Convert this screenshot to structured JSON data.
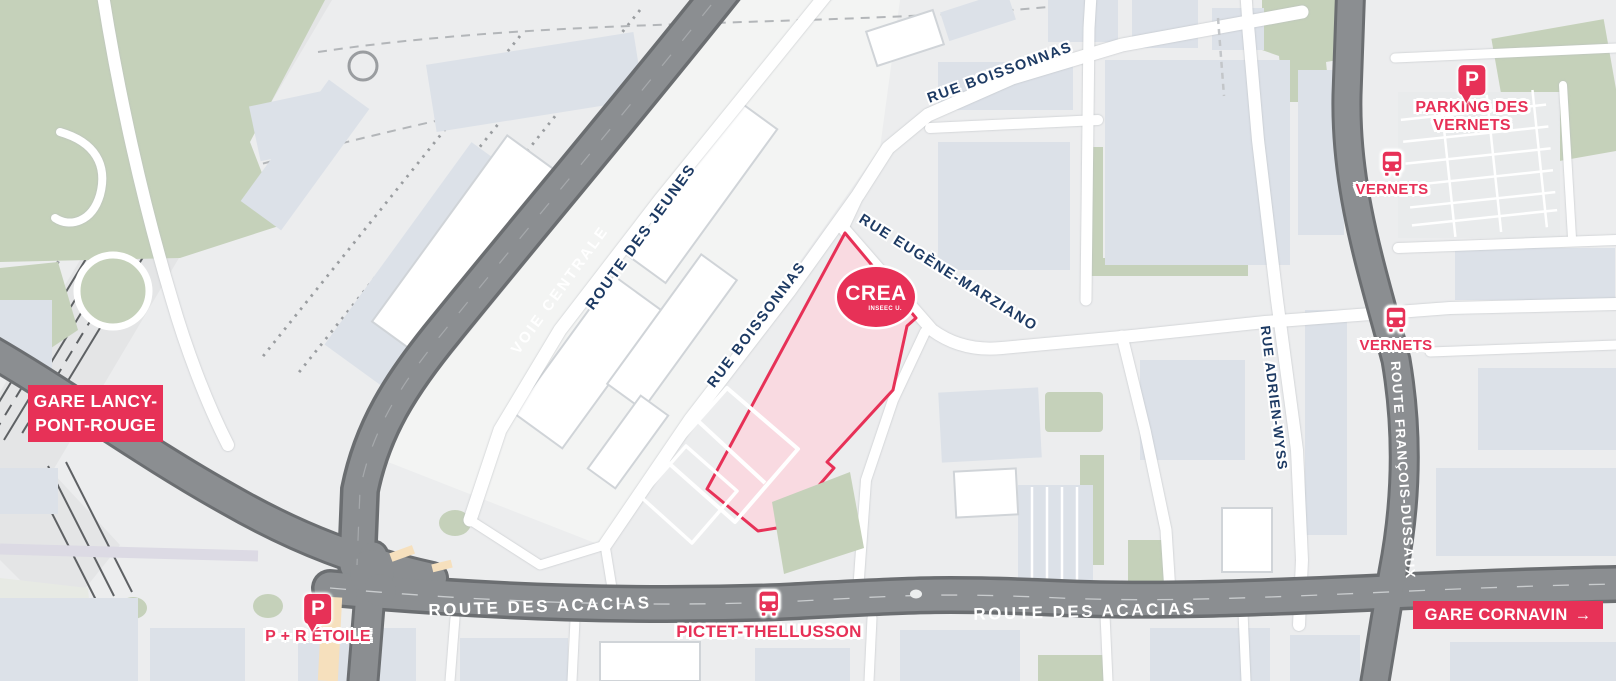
{
  "colors": {
    "accent_pink": "#e73157",
    "street_label_navy": "#1d3a63",
    "road_gray": "#8b8e91",
    "parcel_fill": "#f9dae1",
    "green": "#c5d1ba",
    "building_gray_blue": "#dce1e8",
    "background": "#ecedee",
    "beige": "#f6e0bd"
  },
  "streets": {
    "voie_centrale": "VOIE CENTRALE",
    "route_des_jeunes": "ROUTE DES JEUNES",
    "rue_boissonnas_top": "RUE BOISSONNAS",
    "rue_boissonnas_west": "RUE BOISSONNAS",
    "rue_eugene_marziano": "RUE EUGÈNE-MARZIANO",
    "rue_adrien_wyss": "RUE ADRIEN-WYSS",
    "route_francois_dussaux": "ROUTE FRANÇOIS-DUSSAUX",
    "route_des_acacias_west": "ROUTE DES ACACIAS",
    "route_des_acacias_east": "ROUTE DES ACACIAS"
  },
  "pois": {
    "crea": {
      "name": "CREA",
      "subname": "INSEEC U."
    },
    "parking_des_vernets": {
      "icon": "parking",
      "icon_letter": "P",
      "line1": "PARKING DES",
      "line2": "VERNETS"
    },
    "vernets_stop_north": {
      "icon": "bus",
      "label": "VERNETS"
    },
    "vernets_stop_south": {
      "icon": "bus",
      "label": "VERNETS"
    },
    "gare_lancy_pont_rouge": {
      "line1": "GARE LANCY-",
      "line2": "PONT-ROUGE"
    },
    "p_r_etoile": {
      "icon": "parking",
      "icon_letter": "P",
      "label": "P + R ÉTOILE"
    },
    "pictet_thellusson": {
      "icon": "bus",
      "label": "PICTET-THELLUSSON"
    },
    "gare_cornavin": {
      "label": "GARE CORNAVIN",
      "arrow": "→"
    }
  }
}
